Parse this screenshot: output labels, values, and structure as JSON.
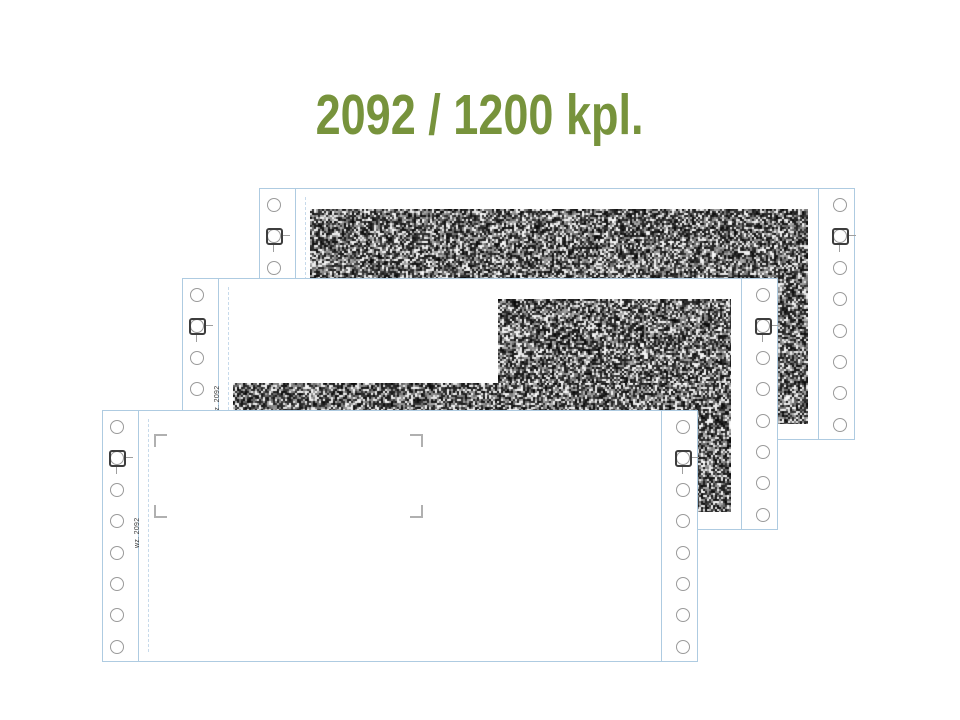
{
  "slide": {
    "title": "2092 / 1200 kpl.",
    "background": "#ffffff"
  },
  "form": {
    "code_label": "wz. 2092",
    "holes_per_edge": 8,
    "copies": [
      {
        "name": "back copy",
        "position": "top-right",
        "printed": "full noise block"
      },
      {
        "name": "middle copy",
        "position": "center",
        "printed": "right block + bottom strip"
      },
      {
        "name": "front sheet",
        "position": "bottom-left",
        "printed": "blank with corner crop marks"
      }
    ]
  },
  "colors": {
    "title_green": "#77933C",
    "sheet_outline_blue": "#aecbe1",
    "perforation_dashed_blue": "#c7daeb",
    "hole_ring_gray": "#9a9a9a",
    "registration_mark_dark": "#3d3d3d",
    "registration_tick_gray": "#9f9f9f",
    "crop_mark_gray": "#b0b0b0",
    "form_code_text": "#3b3b3b",
    "noise_print": "#1a1a1a"
  }
}
